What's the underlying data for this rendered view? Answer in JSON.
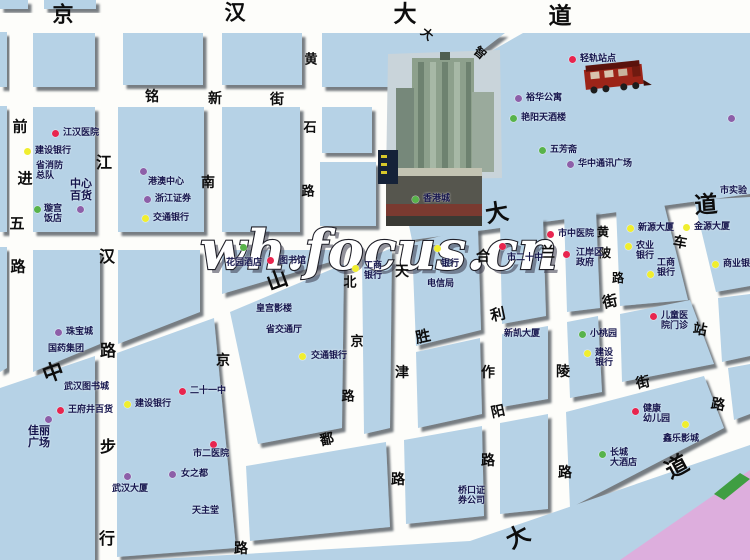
{
  "watermark": "wh.focus.cn",
  "colors": {
    "block": "#b6d2e6",
    "road": "#fdfdfa",
    "river_pink": "#ddaedd",
    "green_shape": "#3f9e42",
    "dot_red": "#e8254e",
    "dot_yellow": "#f0ee2f",
    "dot_purple": "#8d5fa8",
    "dot_green": "#58b34a"
  },
  "map": {
    "streets": [
      {
        "name": "京汉大道",
        "chars": [
          {
            "c": "京",
            "x": 63,
            "y": 14,
            "s": 21,
            "r": 0
          },
          {
            "c": "汉",
            "x": 235,
            "y": 12,
            "s": 21,
            "r": 0
          },
          {
            "c": "大",
            "x": 405,
            "y": 14,
            "s": 23,
            "r": 0
          },
          {
            "c": "道",
            "x": 560,
            "y": 16,
            "s": 23,
            "r": 0
          }
        ]
      },
      {
        "name": "铭新街",
        "chars": [
          {
            "c": "铭",
            "x": 152,
            "y": 97,
            "s": 14,
            "r": 0
          },
          {
            "c": "新",
            "x": 215,
            "y": 99,
            "s": 14,
            "r": 0
          },
          {
            "c": "街",
            "x": 277,
            "y": 100,
            "s": 14,
            "r": 0
          }
        ]
      },
      {
        "name": "前进五路",
        "chars": [
          {
            "c": "前",
            "x": 20,
            "y": 127,
            "s": 15,
            "r": 0
          },
          {
            "c": "进",
            "x": 25,
            "y": 179,
            "s": 15,
            "r": 0
          },
          {
            "c": "五",
            "x": 17,
            "y": 224,
            "s": 15,
            "r": 0
          },
          {
            "c": "路",
            "x": 18,
            "y": 267,
            "s": 15,
            "r": 0
          }
        ]
      },
      {
        "name": "江汉路步行街",
        "chars": [
          {
            "c": "江",
            "x": 104,
            "y": 163,
            "s": 16,
            "r": 0
          },
          {
            "c": "汉",
            "x": 107,
            "y": 257,
            "s": 16,
            "r": 0
          },
          {
            "c": "路",
            "x": 108,
            "y": 351,
            "s": 16,
            "r": 0
          },
          {
            "c": "步",
            "x": 108,
            "y": 447,
            "s": 16,
            "r": 0
          },
          {
            "c": "行",
            "x": 107,
            "y": 539,
            "s": 16,
            "r": 0
          }
        ]
      },
      {
        "name": "南京路",
        "chars": [
          {
            "c": "南",
            "x": 208,
            "y": 183,
            "s": 14,
            "r": 0
          },
          {
            "c": "京",
            "x": 223,
            "y": 361,
            "s": 14,
            "r": 0
          },
          {
            "c": "路",
            "x": 241,
            "y": 549,
            "s": 14,
            "r": 0
          }
        ]
      },
      {
        "name": "黄石路",
        "chars": [
          {
            "c": "黄",
            "x": 311,
            "y": 60,
            "s": 13,
            "r": 0
          },
          {
            "c": "石",
            "x": 310,
            "y": 128,
            "s": 13,
            "r": 0
          },
          {
            "c": "路",
            "x": 308,
            "y": 192,
            "s": 13,
            "r": 0
          }
        ]
      },
      {
        "name": "大智路",
        "chars": [
          {
            "c": "大",
            "x": 427,
            "y": 34,
            "s": 12,
            "r": 40
          },
          {
            "c": "智",
            "x": 480,
            "y": 53,
            "s": 12,
            "r": 40
          }
        ]
      },
      {
        "name": "中山大道",
        "chars": [
          {
            "c": "中",
            "x": 53,
            "y": 372,
            "s": 21,
            "r": -20
          },
          {
            "c": "山",
            "x": 277,
            "y": 280,
            "s": 21,
            "r": -20
          },
          {
            "c": "大",
            "x": 497,
            "y": 213,
            "s": 23,
            "r": -10
          },
          {
            "c": "道",
            "x": 706,
            "y": 205,
            "s": 23,
            "r": -4
          }
        ]
      },
      {
        "name": "北京路",
        "chars": [
          {
            "c": "北",
            "x": 350,
            "y": 283,
            "s": 13,
            "r": 0
          },
          {
            "c": "京",
            "x": 357,
            "y": 342,
            "s": 13,
            "r": 0
          },
          {
            "c": "路",
            "x": 348,
            "y": 397,
            "s": 13,
            "r": 0
          }
        ]
      },
      {
        "name": "天津路",
        "chars": [
          {
            "c": "天",
            "x": 402,
            "y": 272,
            "s": 14,
            "r": 0
          },
          {
            "c": "津",
            "x": 402,
            "y": 373,
            "s": 14,
            "r": 0
          },
          {
            "c": "路",
            "x": 398,
            "y": 480,
            "s": 14,
            "r": 0
          }
        ]
      },
      {
        "name": "合作路",
        "chars": [
          {
            "c": "合",
            "x": 483,
            "y": 257,
            "s": 14,
            "r": 0
          },
          {
            "c": "作",
            "x": 488,
            "y": 373,
            "s": 14,
            "r": 0
          },
          {
            "c": "路",
            "x": 488,
            "y": 461,
            "s": 14,
            "r": 0
          }
        ]
      },
      {
        "name": "兰陵路",
        "chars": [
          {
            "c": "兰",
            "x": 548,
            "y": 253,
            "s": 14,
            "r": 0
          },
          {
            "c": "陵",
            "x": 563,
            "y": 372,
            "s": 14,
            "r": 0
          },
          {
            "c": "路",
            "x": 565,
            "y": 473,
            "s": 14,
            "r": 0
          }
        ]
      },
      {
        "name": "黎黄陂路",
        "chars": [
          {
            "c": "黄",
            "x": 603,
            "y": 232,
            "s": 12,
            "r": 0
          },
          {
            "c": "陂",
            "x": 605,
            "y": 253,
            "s": 12,
            "r": 0
          },
          {
            "c": "路",
            "x": 618,
            "y": 278,
            "s": 12,
            "r": 0
          }
        ]
      },
      {
        "name": "车站路",
        "chars": [
          {
            "c": "车",
            "x": 680,
            "y": 243,
            "s": 14,
            "r": 10
          },
          {
            "c": "站",
            "x": 700,
            "y": 330,
            "s": 14,
            "r": 10
          },
          {
            "c": "路",
            "x": 718,
            "y": 405,
            "s": 14,
            "r": 10
          }
        ]
      },
      {
        "name": "胜利街",
        "chars": [
          {
            "c": "胜",
            "x": 423,
            "y": 337,
            "s": 15,
            "r": -12
          },
          {
            "c": "利",
            "x": 498,
            "y": 315,
            "s": 15,
            "r": -12
          },
          {
            "c": "街",
            "x": 610,
            "y": 302,
            "s": 15,
            "r": -12
          }
        ]
      },
      {
        "name": "鄱阳街",
        "chars": [
          {
            "c": "鄱",
            "x": 327,
            "y": 440,
            "s": 14,
            "r": -12
          },
          {
            "c": "阳",
            "x": 498,
            "y": 412,
            "s": 14,
            "r": -12
          },
          {
            "c": "街",
            "x": 643,
            "y": 383,
            "s": 14,
            "r": -12
          }
        ]
      },
      {
        "name": "沿江大道",
        "chars": [
          {
            "c": "大",
            "x": 518,
            "y": 537,
            "s": 23,
            "r": -28
          },
          {
            "c": "道",
            "x": 677,
            "y": 467,
            "s": 23,
            "r": -28
          }
        ]
      }
    ],
    "pois": [
      {
        "name": "江汉医院",
        "dot": "red",
        "dx": 55,
        "dy": 133,
        "lines": [
          "江汉医院"
        ],
        "lx": 63,
        "ly": 128
      },
      {
        "name": "建设银行",
        "dot": "yellow",
        "dx": 27,
        "dy": 151,
        "lines": [
          "建设银行"
        ],
        "lx": 35,
        "ly": 146
      },
      {
        "name": "省消防总队",
        "dot": null,
        "lines": [
          "省消防",
          "总队"
        ],
        "lx": 36,
        "ly": 161
      },
      {
        "name": "中心百货",
        "dot": "purple",
        "dx": 80,
        "dy": 209,
        "lines": [
          "中心",
          "百货"
        ],
        "lx": 70,
        "ly": 178,
        "size": 11
      },
      {
        "name": "璇宫饭店",
        "dot": "green",
        "dx": 37,
        "dy": 209,
        "lines": [
          "璇宫",
          "饭店"
        ],
        "lx": 44,
        "ly": 204
      },
      {
        "name": "港澳中心",
        "dot": "purple",
        "dx": 143,
        "dy": 171,
        "lines": [
          "港澳中心"
        ],
        "lx": 148,
        "ly": 177
      },
      {
        "name": "浙江证券",
        "dot": "purple",
        "dx": 147,
        "dy": 199,
        "lines": [
          "浙江证券"
        ],
        "lx": 155,
        "ly": 194
      },
      {
        "name": "交通银行",
        "dot": "yellow",
        "dx": 145,
        "dy": 218,
        "lines": [
          "交通银行"
        ],
        "lx": 153,
        "ly": 213
      },
      {
        "name": "珠宝城",
        "dot": "purple",
        "dx": 58,
        "dy": 332,
        "lines": [
          "珠宝城"
        ],
        "lx": 66,
        "ly": 327
      },
      {
        "name": "国药集团",
        "dot": null,
        "lines": [
          "国药集团"
        ],
        "lx": 48,
        "ly": 344
      },
      {
        "name": "武汉图书城",
        "dot": null,
        "lines": [
          "武汉图书城"
        ],
        "lx": 64,
        "ly": 382
      },
      {
        "name": "王府井百货",
        "dot": "red",
        "dx": 60,
        "dy": 410,
        "lines": [
          "王府井百货"
        ],
        "lx": 68,
        "ly": 405
      },
      {
        "name": "佳丽广场",
        "dot": "purple",
        "dx": 48,
        "dy": 419,
        "lines": [
          "佳丽",
          "广场"
        ],
        "lx": 28,
        "ly": 425,
        "size": 11
      },
      {
        "name": "建设银行",
        "dot": "yellow",
        "dx": 127,
        "dy": 404,
        "lines": [
          "建设银行"
        ],
        "lx": 135,
        "ly": 399
      },
      {
        "name": "二十一中",
        "dot": "red",
        "dx": 182,
        "dy": 391,
        "lines": [
          "二十一中"
        ],
        "lx": 190,
        "ly": 386
      },
      {
        "name": "市二医院",
        "dot": "red",
        "dx": 213,
        "dy": 444,
        "lines": [
          "市二医院"
        ],
        "lx": 193,
        "ly": 449
      },
      {
        "name": "武汉大厦",
        "dot": "purple",
        "dx": 127,
        "dy": 476,
        "lines": [
          "武汉大厦"
        ],
        "lx": 112,
        "ly": 484
      },
      {
        "name": "女之都",
        "dot": "purple",
        "dx": 172,
        "dy": 474,
        "lines": [
          "女之都"
        ],
        "lx": 181,
        "ly": 469
      },
      {
        "name": "天主堂",
        "dot": null,
        "lines": [
          "天主堂"
        ],
        "lx": 192,
        "ly": 506
      },
      {
        "name": "花园酒店",
        "dot": "green",
        "dx": 243,
        "dy": 247,
        "lines": [
          "花园酒店"
        ],
        "lx": 226,
        "ly": 258
      },
      {
        "name": "图书馆",
        "dot": "red",
        "dx": 270,
        "dy": 260,
        "lines": [
          "图书馆"
        ],
        "lx": 279,
        "ly": 256
      },
      {
        "name": "皇宫影楼",
        "dot": null,
        "lines": [
          "皇宫影楼"
        ],
        "lx": 256,
        "ly": 304
      },
      {
        "name": "省交通厅",
        "dot": null,
        "lines": [
          "省交通厅"
        ],
        "lx": 266,
        "ly": 325
      },
      {
        "name": "交通银行",
        "dot": "yellow",
        "dx": 302,
        "dy": 356,
        "lines": [
          "交通银行"
        ],
        "lx": 311,
        "ly": 351
      },
      {
        "name": "工商银行",
        "dot": "yellow",
        "dx": 355,
        "dy": 268,
        "lines": [
          "工商",
          "银行"
        ],
        "lx": 364,
        "ly": 261
      },
      {
        "name": "电信局",
        "dot": null,
        "lines": [
          "电信局"
        ],
        "lx": 427,
        "ly": 279
      },
      {
        "name": "银行",
        "dot": "yellow",
        "dx": 437,
        "dy": 248,
        "lines": [
          "银行"
        ],
        "lx": 441,
        "ly": 259
      },
      {
        "name": "市中医院",
        "dot": "red",
        "dx": 550,
        "dy": 234,
        "lines": [
          "市中医院"
        ],
        "lx": 558,
        "ly": 229
      },
      {
        "name": "市二十中",
        "dot": "red",
        "dx": 502,
        "dy": 246,
        "lines": [
          "市二十中"
        ],
        "lx": 507,
        "ly": 253
      },
      {
        "name": "江岸区政府",
        "dot": "red",
        "dx": 566,
        "dy": 254,
        "lines": [
          "江岸区",
          "政府"
        ],
        "lx": 576,
        "ly": 248
      },
      {
        "name": "新源大厦",
        "dot": "yellow",
        "dx": 630,
        "dy": 228,
        "lines": [
          "新源大厦"
        ],
        "lx": 638,
        "ly": 223
      },
      {
        "name": "金源大厦",
        "dot": "yellow",
        "dx": 686,
        "dy": 227,
        "lines": [
          "金源大厦"
        ],
        "lx": 694,
        "ly": 222
      },
      {
        "name": "农业银行",
        "dot": "yellow",
        "dx": 628,
        "dy": 246,
        "lines": [
          "农业",
          "银行"
        ],
        "lx": 636,
        "ly": 241
      },
      {
        "name": "工商银行",
        "dot": "yellow",
        "dx": 650,
        "dy": 274,
        "lines": [
          "工商",
          "银行"
        ],
        "lx": 657,
        "ly": 258
      },
      {
        "name": "商业银行",
        "dot": "yellow",
        "dx": 715,
        "dy": 264,
        "lines": [
          "商业银行"
        ],
        "lx": 723,
        "ly": 259
      },
      {
        "name": "儿童医院门诊",
        "dot": "red",
        "dx": 653,
        "dy": 316,
        "lines": [
          "儿童医",
          "院门诊"
        ],
        "lx": 661,
        "ly": 311
      },
      {
        "name": "小桃园",
        "dot": "green",
        "dx": 582,
        "dy": 334,
        "lines": [
          "小桃园"
        ],
        "lx": 590,
        "ly": 329
      },
      {
        "name": "建设银行",
        "dot": "yellow",
        "dx": 587,
        "dy": 353,
        "lines": [
          "建设",
          "银行"
        ],
        "lx": 595,
        "ly": 348
      },
      {
        "name": "新凯大厦",
        "dot": null,
        "lines": [
          "新凯大厦"
        ],
        "lx": 504,
        "ly": 329
      },
      {
        "name": "健康幼儿园",
        "dot": "red",
        "dx": 635,
        "dy": 411,
        "lines": [
          "健康",
          "幼儿园"
        ],
        "lx": 643,
        "ly": 404
      },
      {
        "name": "鑫乐影城",
        "dot": "yellow",
        "dx": 685,
        "dy": 424,
        "lines": [
          "鑫乐影城"
        ],
        "lx": 663,
        "ly": 434
      },
      {
        "name": "长城大酒店",
        "dot": "green",
        "dx": 602,
        "dy": 454,
        "lines": [
          "长城",
          "大酒店"
        ],
        "lx": 610,
        "ly": 448
      },
      {
        "name": "桥口证券公司",
        "dot": null,
        "lines": [
          "桥口证",
          "券公司"
        ],
        "lx": 458,
        "ly": 486
      },
      {
        "name": "轻轨站点",
        "dot": "red",
        "dx": 572,
        "dy": 59,
        "lines": [
          "轻轨站点"
        ],
        "lx": 580,
        "ly": 54
      },
      {
        "name": "裕华公寓",
        "dot": "purple",
        "dx": 518,
        "dy": 98,
        "lines": [
          "裕华公寓"
        ],
        "lx": 526,
        "ly": 93
      },
      {
        "name": "艳阳天酒楼",
        "dot": "green",
        "dx": 513,
        "dy": 118,
        "lines": [
          "艳阳天酒楼"
        ],
        "lx": 521,
        "ly": 113
      },
      {
        "name": "五芳斋",
        "dot": "green",
        "dx": 542,
        "dy": 150,
        "lines": [
          "五芳斋"
        ],
        "lx": 550,
        "ly": 145
      },
      {
        "name": "华中通讯广场",
        "dot": "purple",
        "dx": 570,
        "dy": 164,
        "lines": [
          "华中通讯广场"
        ],
        "lx": 578,
        "ly": 159
      },
      {
        "name": "香港城",
        "dot": "green",
        "dx": 415,
        "dy": 199,
        "lines": [
          "香港城"
        ],
        "lx": 423,
        "ly": 194
      },
      {
        "name": "边缘标注",
        "dot": "purple",
        "dx": 731,
        "dy": 118,
        "lines": [],
        "lx": 738,
        "ly": 113
      },
      {
        "name": "市实验",
        "dot": null,
        "lines": [
          "市实验"
        ],
        "lx": 720,
        "ly": 186
      }
    ]
  }
}
